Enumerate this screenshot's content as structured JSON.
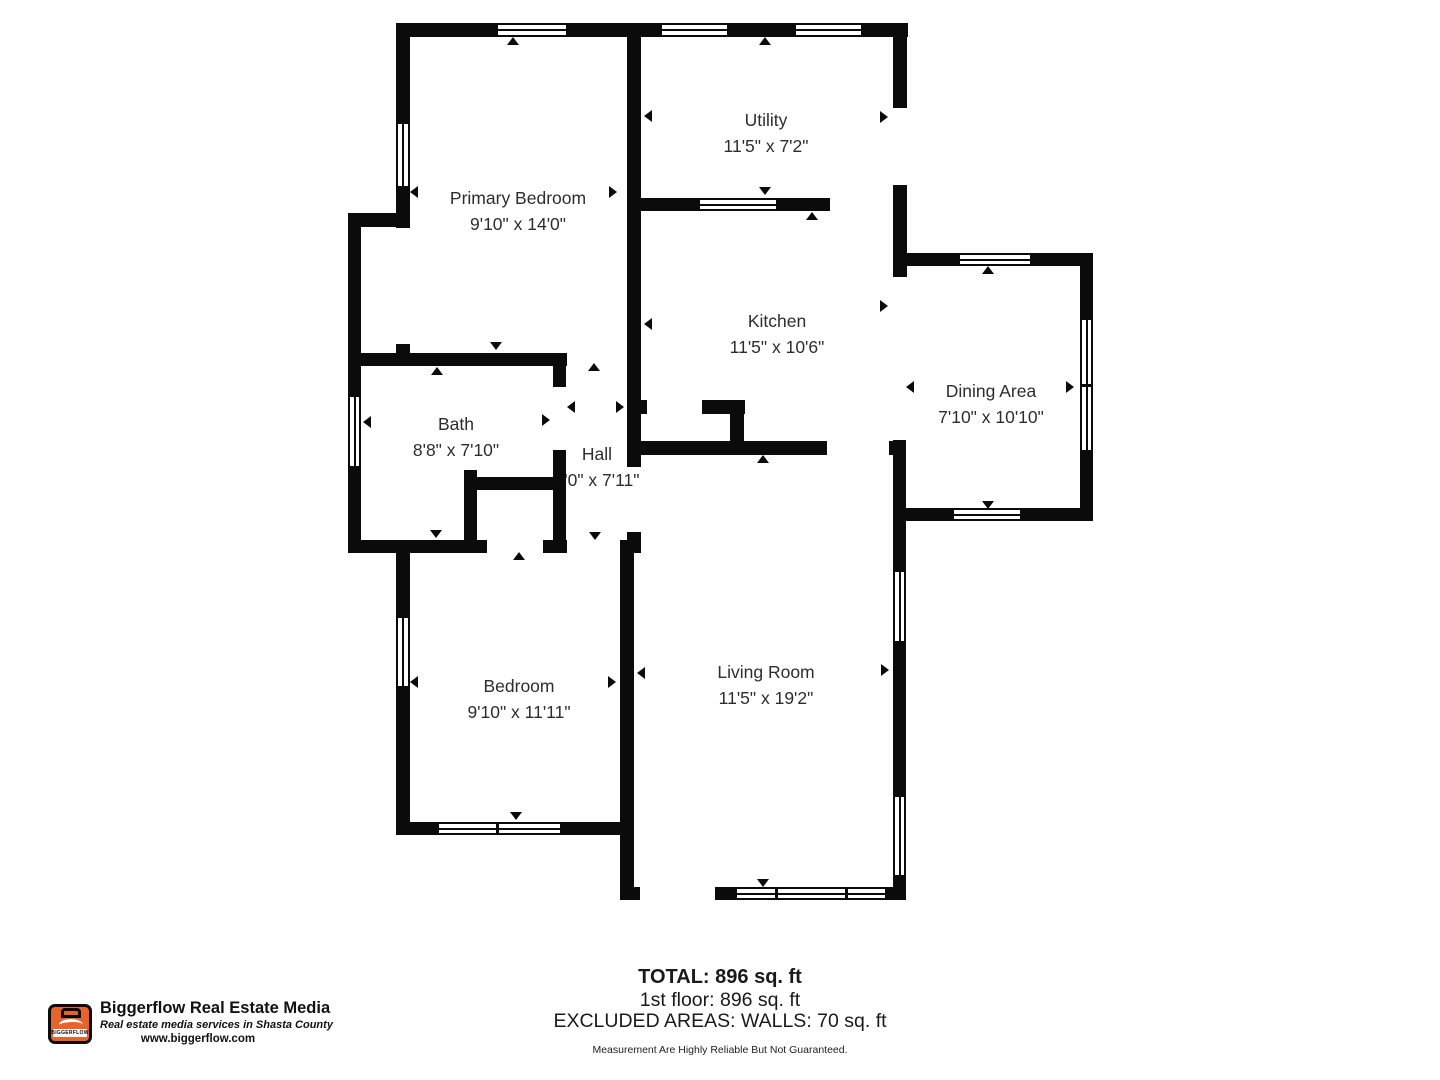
{
  "rooms": [
    {
      "name": "Primary Bedroom",
      "dims": "9'10\" x 14'0\""
    },
    {
      "name": "Utility",
      "dims": "11'5\" x 7'2\""
    },
    {
      "name": "Kitchen",
      "dims": "11'5\" x 10'6\""
    },
    {
      "name": "Dining Area",
      "dims": "7'10\" x 10'10\""
    },
    {
      "name": "Bath",
      "dims": "8'8\" x 7'10\""
    },
    {
      "name": "Hall",
      "dims": "3'0\" x 7'11\""
    },
    {
      "name": "Bedroom",
      "dims": "9'10\" x 11'11\""
    },
    {
      "name": "Living Room",
      "dims": "11'5\" x 19'2\""
    }
  ],
  "summary": {
    "total": "TOTAL: 896 sq. ft",
    "first_floor": "1st floor: 896 sq. ft",
    "excluded": "EXCLUDED AREAS: WALLS: 70 sq. ft",
    "disclaimer": "Measurement Are Highly Reliable But Not Guaranteed."
  },
  "branding": {
    "company": "Biggerflow Real Estate Media",
    "tagline": "Real estate media services in Shasta County",
    "website": "www.biggerflow.com",
    "logo_text": "BIGGERFLOW",
    "logo_color": "#E8632C"
  }
}
